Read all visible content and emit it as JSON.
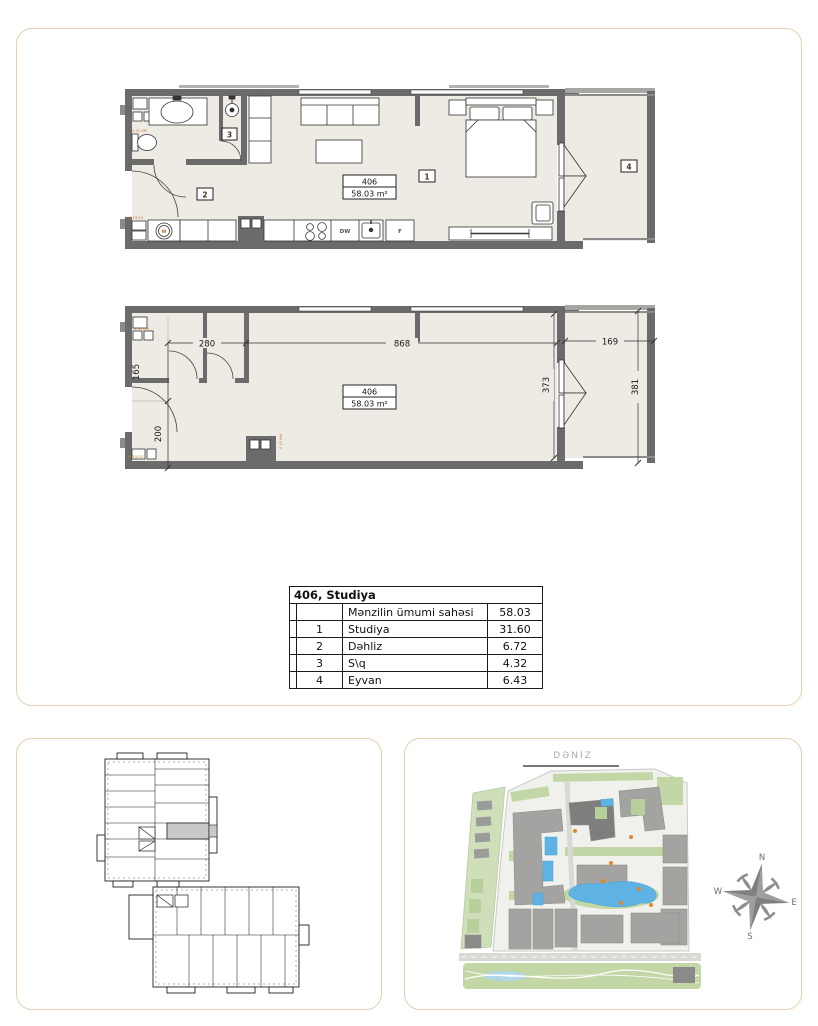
{
  "unit": {
    "number": "406",
    "area": "58.03 m²",
    "title": "406, Studiya"
  },
  "plans": {
    "furnished": {
      "unit_number": "406",
      "unit_area": "58.03 m²",
      "room_1": "1",
      "room_2": "2",
      "room_3": "3",
      "room_4": "4",
      "washer": "W",
      "dishwasher": "DW",
      "fridge": "F",
      "riser_top": "S Gİ HM",
      "riser_bottom": "HS 15/15"
    },
    "dimensioned": {
      "unit_number": "406",
      "unit_area": "58.03 m²",
      "dim_h": [
        "280",
        "868",
        "169"
      ],
      "dim_v": [
        "165",
        "200",
        "373",
        "381"
      ],
      "riser_top": "S Gİ HM",
      "riser_bottom": "HS 15/15",
      "shaft_label": "S Gİ HM"
    }
  },
  "area_table": {
    "title": "406, Studiya",
    "rows": [
      {
        "num": "",
        "label": "Mənzilin ümumi sahəsi",
        "value": "58.03"
      },
      {
        "num": "1",
        "label": "Studiya",
        "value": "31.60"
      },
      {
        "num": "2",
        "label": "Dəhliz",
        "value": "6.72"
      },
      {
        "num": "3",
        "label": "S\\q",
        "value": "4.32"
      },
      {
        "num": "4",
        "label": "Eyvan",
        "value": "6.43"
      }
    ]
  },
  "site": {
    "sea_label": "DƏNİZ",
    "compass": {
      "north": "N",
      "east": "E",
      "south": "S",
      "west": "W"
    }
  },
  "colors": {
    "wall": "#6b6b6b",
    "floor": "#eeebe4",
    "accent": "#c87a30",
    "pool": "#5fb3e4",
    "green": "#c3d7a6",
    "building": "#a3a3a1",
    "panel_border": "#e5cfae"
  }
}
